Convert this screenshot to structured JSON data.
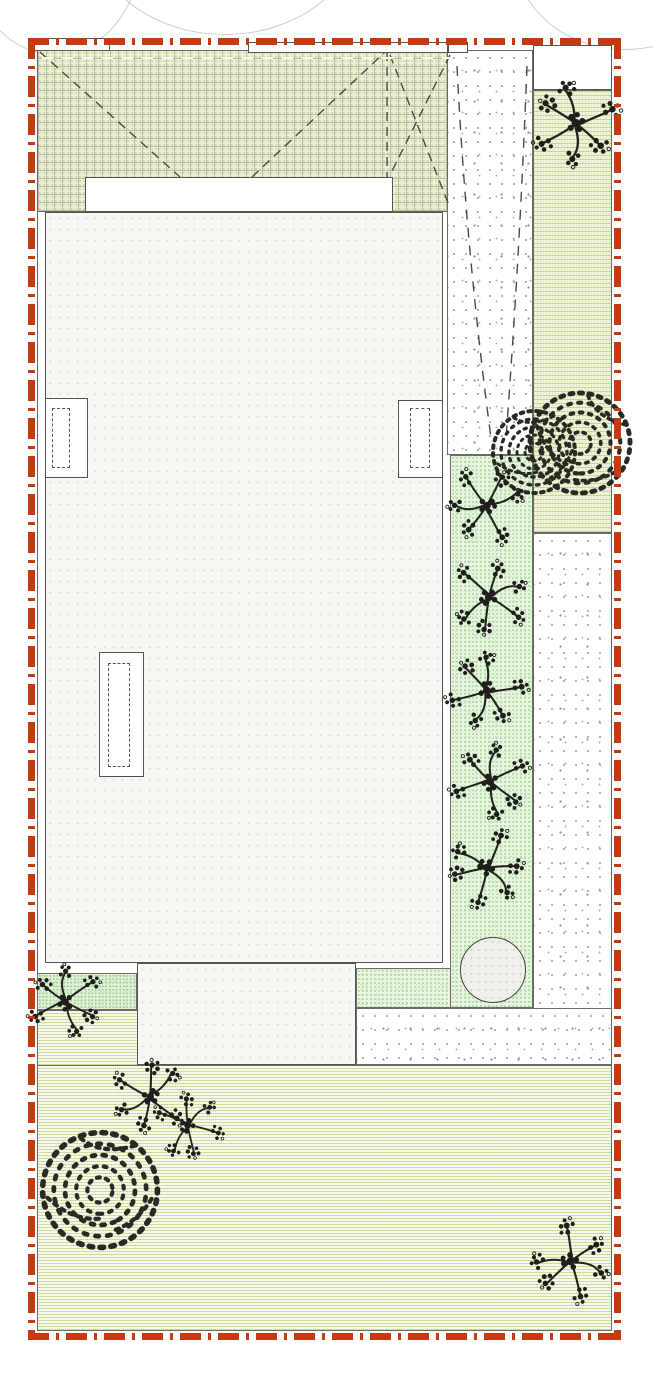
{
  "plan": {
    "kind": "landscape-site-plan",
    "visible_text": [],
    "boundary": {
      "style": "dash-dot",
      "color": "#c63a10"
    },
    "colors": {
      "canopy_grid_fill": "#eef1d8",
      "lawn_fill": "#f3f5e1",
      "side_strip_fill": "#f1f3dd",
      "planting_bed_fill": "#e9f5e1",
      "bright_patch_fill": "#e2f2da",
      "gravel_fill": "#ffffff",
      "building_fill": "#f7f7f4",
      "linework": "#55554f",
      "foliage": "#1e1e1a"
    },
    "areas": [
      {
        "name": "gridded-canopy-roof"
      },
      {
        "name": "main-building"
      },
      {
        "name": "gravel-driveway"
      },
      {
        "name": "entry-pad"
      },
      {
        "name": "east-side-strip"
      },
      {
        "name": "east-gravel-path"
      },
      {
        "name": "east-planting-bed"
      },
      {
        "name": "rear-patio"
      },
      {
        "name": "rear-lawn"
      },
      {
        "name": "west-green-patch"
      },
      {
        "name": "stone-disc-feature"
      }
    ]
  },
  "plants": [
    {
      "type": "tree",
      "x": 575,
      "y": 123,
      "size": 96,
      "rot": 15
    },
    {
      "type": "shrub",
      "x": 534,
      "y": 452,
      "size": 100,
      "rot": 0
    },
    {
      "type": "shrub",
      "x": 580,
      "y": 443,
      "size": 122,
      "rot": 40
    },
    {
      "type": "tree",
      "x": 487,
      "y": 505,
      "size": 86,
      "rot": 100
    },
    {
      "type": "tree",
      "x": 489,
      "y": 598,
      "size": 86,
      "rot": 260
    },
    {
      "type": "tree",
      "x": 486,
      "y": 690,
      "size": 86,
      "rot": 30
    },
    {
      "type": "tree",
      "x": 491,
      "y": 782,
      "size": 86,
      "rot": 200
    },
    {
      "type": "tree",
      "x": 486,
      "y": 868,
      "size": 86,
      "rot": 330
    },
    {
      "type": "tree",
      "x": 66,
      "y": 1002,
      "size": 82,
      "rot": 190
    },
    {
      "type": "tree",
      "x": 150,
      "y": 1096,
      "size": 84,
      "rot": 75
    },
    {
      "type": "tree",
      "x": 188,
      "y": 1126,
      "size": 76,
      "rot": 240
    },
    {
      "type": "shrub",
      "x": 100,
      "y": 1190,
      "size": 140,
      "rot": 10
    },
    {
      "type": "tree",
      "x": 570,
      "y": 1262,
      "size": 88,
      "rot": 300
    }
  ]
}
